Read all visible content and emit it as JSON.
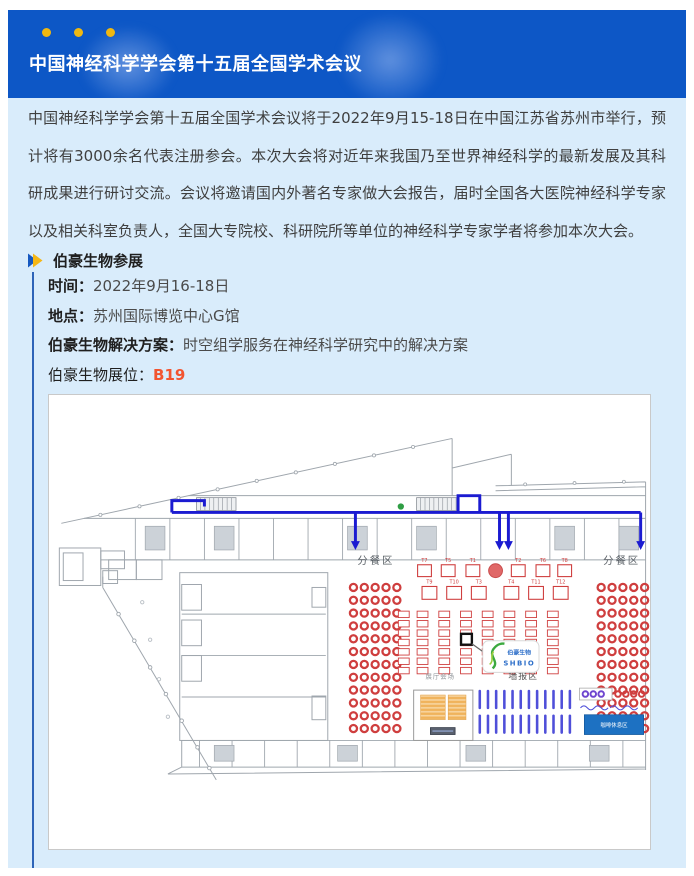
{
  "banner": {
    "title": "中国神经科学学会第十五届全国学术会议",
    "bg_color": "#0d57c6",
    "dot_color": "#f0b810"
  },
  "intro": {
    "text": "中国神经科学学会第十五届全国学术会议将于2022年9月15-18日在中国江苏省苏州市举行，预计将有3000余名代表注册参会。本次大会将对近年来我国乃至世界神经科学的最新发展及其科研成果进行研讨交流。会议将邀请国内外著名专家做大会报告，届时全国各大医院神经科学专家以及相关科室负责人，全国大专院校、科研院所等单位的神经科学专家学者将参加本次大会。"
  },
  "section": {
    "heading": "伯豪生物参展",
    "details": [
      {
        "label": "时间：",
        "value": "2022年9月16-18日"
      },
      {
        "label": "地点：",
        "value": "苏州国际博览中心G馆"
      },
      {
        "label": "伯豪生物解决方案：",
        "value": "时空组学服务在神经科学研究中的解决方案"
      },
      {
        "label": "伯豪生物展位：",
        "value": "B19",
        "value_color": "#f25430"
      }
    ]
  },
  "map": {
    "labels": {
      "dining_left": "分餐区",
      "dining_right": "分餐区",
      "hall_venue": "展厅会场",
      "poster_area": "墙报区",
      "coffee_area": "咖啡休息区",
      "logo_name": "伯豪生物",
      "logo_sub": "SHBIO"
    },
    "tables_row1": [
      "T7",
      "T5",
      "T1",
      "T2",
      "T6",
      "T8"
    ],
    "tables_row2": [
      "T9",
      "T10",
      "T3",
      "T4",
      "T11",
      "T12"
    ],
    "booth_highlight": "B19",
    "colors": {
      "route": "#1b1bd1",
      "red": "#cf3e3e",
      "orange": "#f0b35c",
      "poster_stripe": "#4f4fd9",
      "coffee": "#1d71c2",
      "purple": "#6f46cf",
      "green_dot": "#2f9e44",
      "structure": "#9fa6ad"
    }
  }
}
